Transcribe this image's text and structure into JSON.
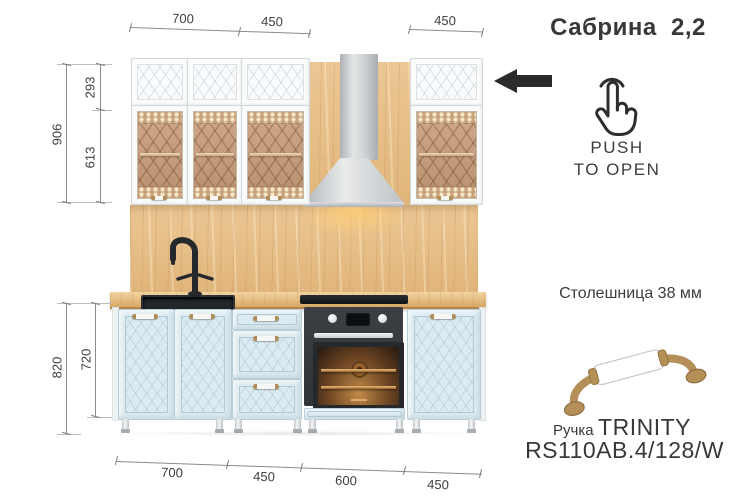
{
  "title": "Сабрина  2,2",
  "dimensions": {
    "top": {
      "w700": "700",
      "w450_left": "450",
      "w450_right": "450"
    },
    "left_upper": {
      "total": "906",
      "top_box": "293",
      "glass_box": "613"
    },
    "left_lower": {
      "total": "820",
      "cabinet": "720"
    },
    "bottom": {
      "w700": "700",
      "w450_drawers": "450",
      "w600": "600",
      "w450_right": "450"
    }
  },
  "callouts": {
    "push_to_open_line1": "PUSH",
    "push_to_open_line2": "TO OPEN",
    "countertop": "Столешница 38 мм",
    "handle_prefix": "Ручка",
    "handle_name": "TRINITY",
    "handle_model": "RS110AB.4/128/W"
  },
  "colors": {
    "base_cabinet_blue": "#dcebf1",
    "upper_cabinet_white": "#fcfdfd",
    "wood_oak": "#e7bf8a",
    "brass": "#b08d57",
    "appliance_dark": "#2f3337",
    "text_ink": "#3a3a3d"
  }
}
